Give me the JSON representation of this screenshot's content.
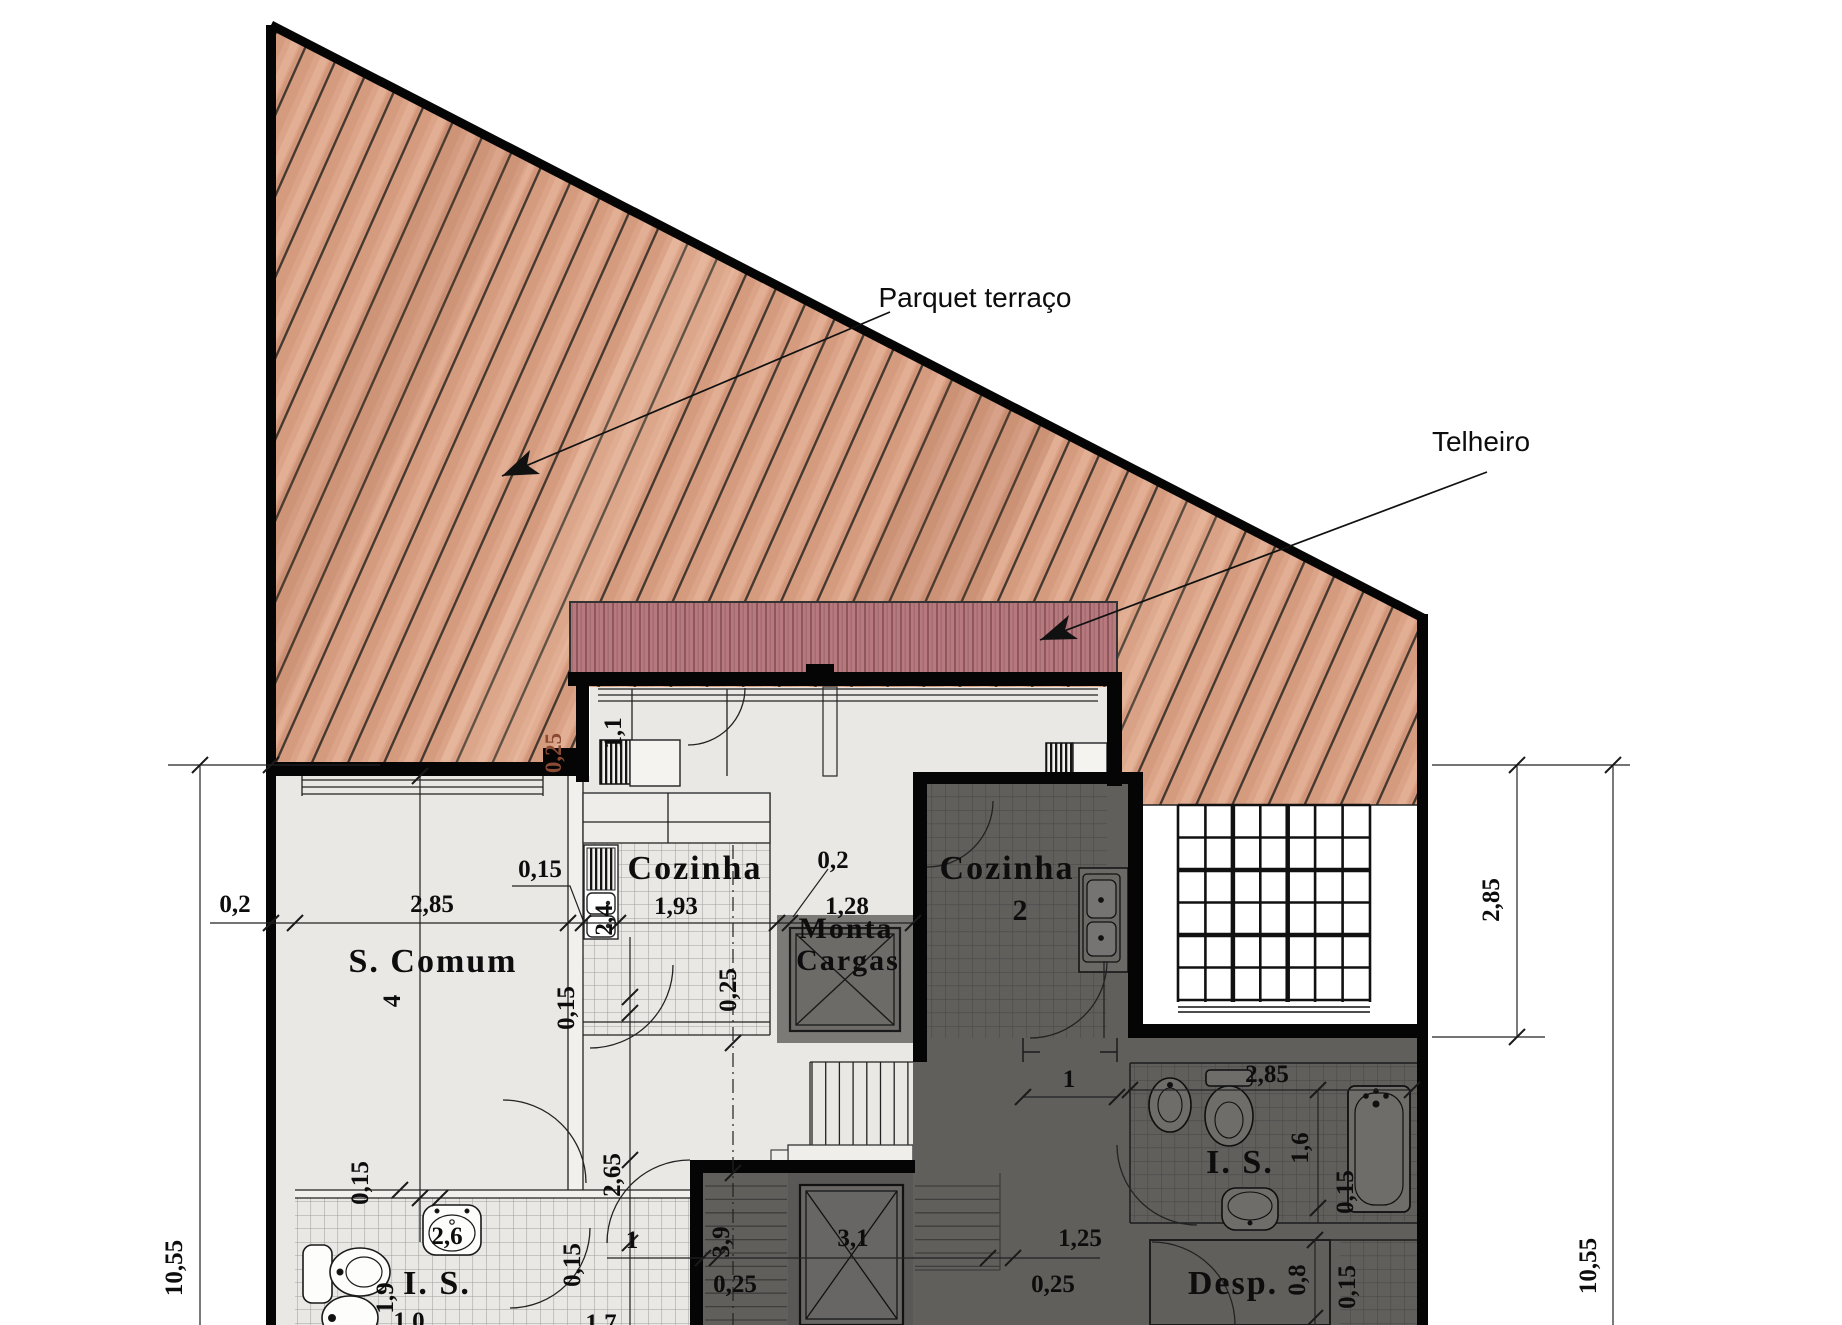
{
  "annotations": {
    "parquet_terrace": "Parquet terraço",
    "shelter": "Telheiro"
  },
  "rooms": {
    "s_comum": {
      "label": "S. Comum",
      "number": "4"
    },
    "cozinha_left": {
      "label": "Cozinha",
      "number": "1,93"
    },
    "monta_cargas": {
      "line1": "Monta",
      "line2": "Cargas"
    },
    "cozinha_right": {
      "label": "Cozinha",
      "number": "2"
    },
    "is_left": {
      "label": "I. S."
    },
    "is_right": {
      "label": "I. S."
    },
    "desp": {
      "label": "Desp."
    }
  },
  "dims": {
    "left_0_2": "0,2",
    "left_2_85": "2,85",
    "left_10_55": "10,55",
    "right_2_85": "2,85",
    "right_10_55": "10,55",
    "d_0_15_a": "0,15",
    "d_0_2_b": "0,2",
    "d_1_28": "1,28",
    "d_2_4": "2,4",
    "d_1_1": "1,1",
    "d_0_25_brown": "0,25",
    "d_0_25_a": "0,25",
    "d_0_15_b": "0,15",
    "d_2_6": "2,6",
    "d_1_9": "1,9",
    "d_1_0": "1,0",
    "d_0_15_c": "0,15",
    "d_2_65": "2,65",
    "d_1_a": "1",
    "d_1_7": "1,7",
    "d_0_15_d": "0,15",
    "d_3_9": "3,9",
    "d_0_25_b": "0,25",
    "d_3_1": "3,1",
    "d_0_25_c": "0,25",
    "d_1_25": "1,25",
    "d_1_b": "1",
    "d_2_85_bath": "2,85",
    "d_1_6": "1,6",
    "d_0_15_e": "0,15",
    "d_0_8": "0,8",
    "d_0_15_f": "0,15"
  },
  "colors": {
    "deck_wood": "#dba489",
    "plank_line": "#45382e",
    "roof": "#b7797d",
    "roof_stripe": "#8e575c",
    "floor_light": "#e9e8e5",
    "floor_dark": "#605f5c",
    "wall": "#050505",
    "annotation_brown": "#8a4a33",
    "skylight": "#ffffff"
  }
}
